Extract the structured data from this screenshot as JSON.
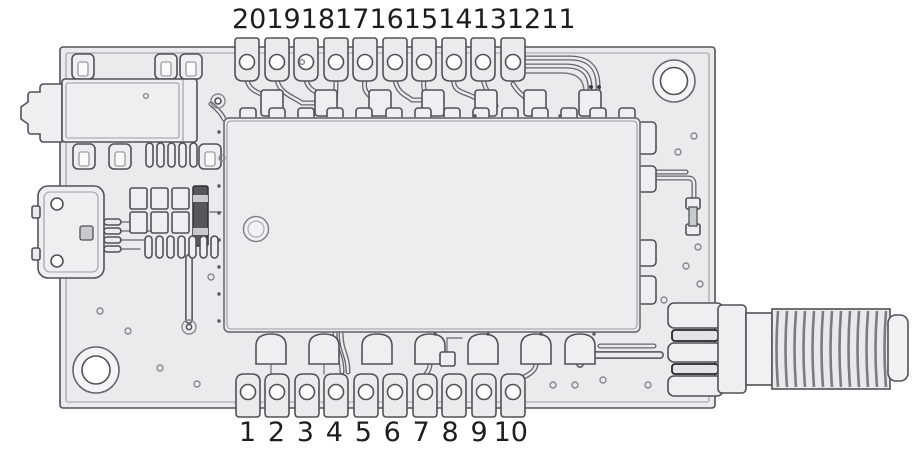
{
  "pins": {
    "top": [
      "20",
      "19",
      "18",
      "17",
      "16",
      "15",
      "14",
      "13",
      "12",
      "11"
    ],
    "bottom": [
      "1",
      "2",
      "3",
      "4",
      "5",
      "6",
      "7",
      "8",
      "9",
      "10"
    ]
  },
  "board": {
    "icons": [
      "audio-jack-connector",
      "micro-usb-connector",
      "sma-antenna-connector",
      "rf-module-shield",
      "pin1-marker-dot",
      "mounting-hole-top-right",
      "mounting-hole-bottom-left",
      "castellated-pin-pads"
    ]
  },
  "colors": {
    "background": "#ffffff",
    "board_fill": "#ebebed",
    "board_outline": "#515257",
    "detail_line": "#9b9ca1",
    "component_dark": "#56575c",
    "label_text": "#1d1d1f"
  }
}
